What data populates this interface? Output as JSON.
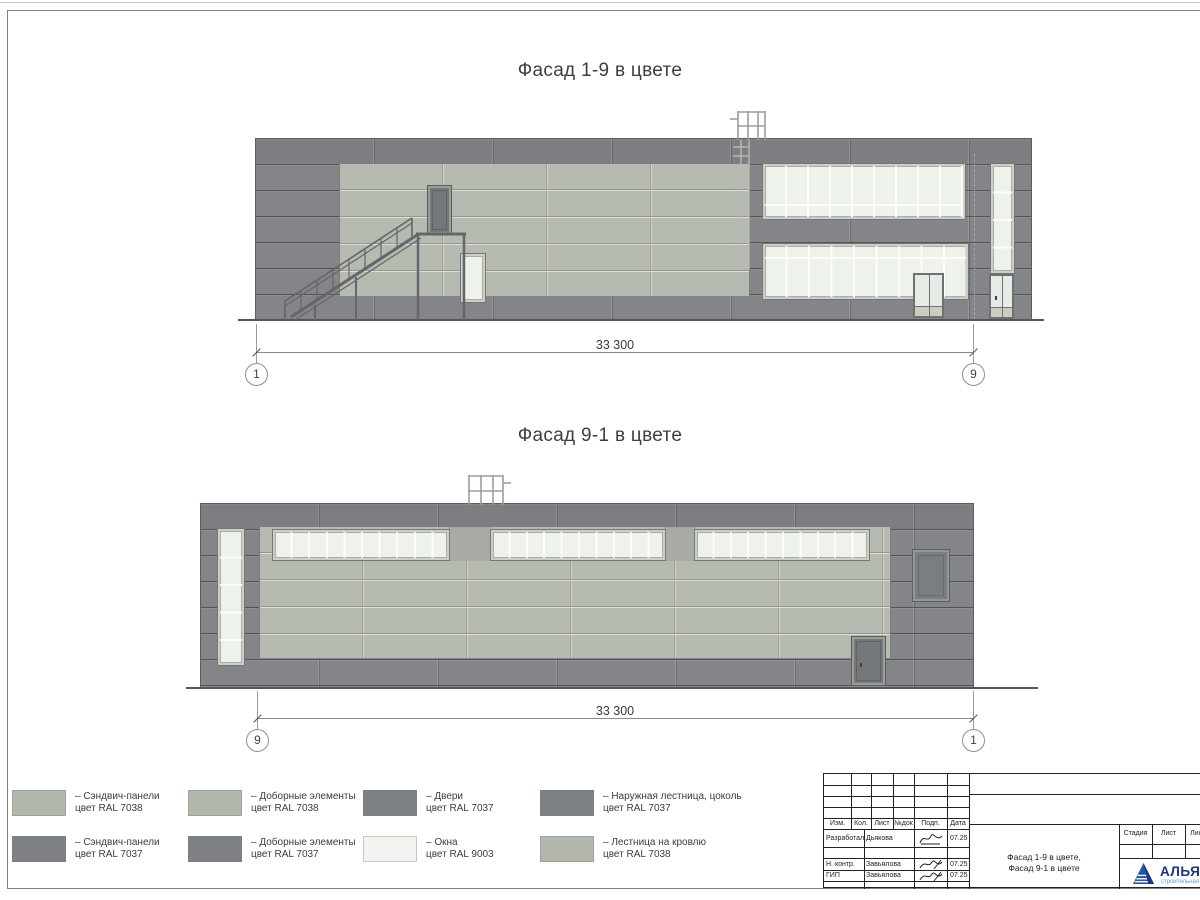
{
  "facade1": {
    "title": "Фасад 1-9 в цвете",
    "dimension": "33 300",
    "axis_left": "1",
    "axis_right": "9"
  },
  "facade2": {
    "title": "Фасад 9-1 в цвете",
    "dimension": "33 300",
    "axis_left": "9",
    "axis_right": "1"
  },
  "colors": {
    "ral7038_light_panel": "#b2b7ac",
    "ral7037_dark_panel": "#7e8183",
    "ral9003_window": "#f1f4ef",
    "glass": "#edf2ec",
    "logo_blue": "#17357f",
    "logo_light_blue": "#56a6d8"
  },
  "legend": {
    "items": [
      {
        "color": "#b2b7ac",
        "line1": "– Сэндвич-панели",
        "line2": "цвет RAL 7038"
      },
      {
        "color": "#b2b7ac",
        "line1": "– Доборные элементы",
        "line2": "цвет RAL 7038"
      },
      {
        "color": "#7e8183",
        "line1": "– Двери",
        "line2": "цвет RAL 7037"
      },
      {
        "color": "#7e8183",
        "line1": "– Наружная лестница, цоколь",
        "line2": "цвет RAL 7037"
      },
      {
        "color": "#7e8183",
        "line1": "– Сэндвич-панели",
        "line2": "цвет RAL 7037"
      },
      {
        "color": "#7e8183",
        "line1": "– Доборные элементы",
        "line2": "цвет RAL 7037"
      },
      {
        "color": "#f1f4ef",
        "line1": "– Окна",
        "line2": "цвет RAL 9003"
      },
      {
        "color": "#b2b7ac",
        "line1": "– Лестница на кровлю",
        "line2": "цвет RAL 7038"
      }
    ]
  },
  "titleblock": {
    "rev_headers": [
      "Изм.",
      "Кол.",
      "Лист",
      "№док",
      "Подп.",
      "Дата"
    ],
    "rows": [
      {
        "role": "Разработал",
        "name": "Дьякова",
        "date": "07.25"
      },
      {
        "role": "Н. контр.",
        "name": "Завьялова",
        "date": "07.25"
      },
      {
        "role": "ГИП",
        "name": "Завьялова",
        "date": "07.25"
      }
    ],
    "doc_title_line1": "Фасад 1-9 в цвете,",
    "doc_title_line2": "Фасад 9-1 в цвете",
    "stage_header": "Стадия",
    "sheet_header": "Лист",
    "sheets_header": "Листов",
    "logo_text": "АЛЬЯНС",
    "logo_subtitle": "строительная компания"
  }
}
